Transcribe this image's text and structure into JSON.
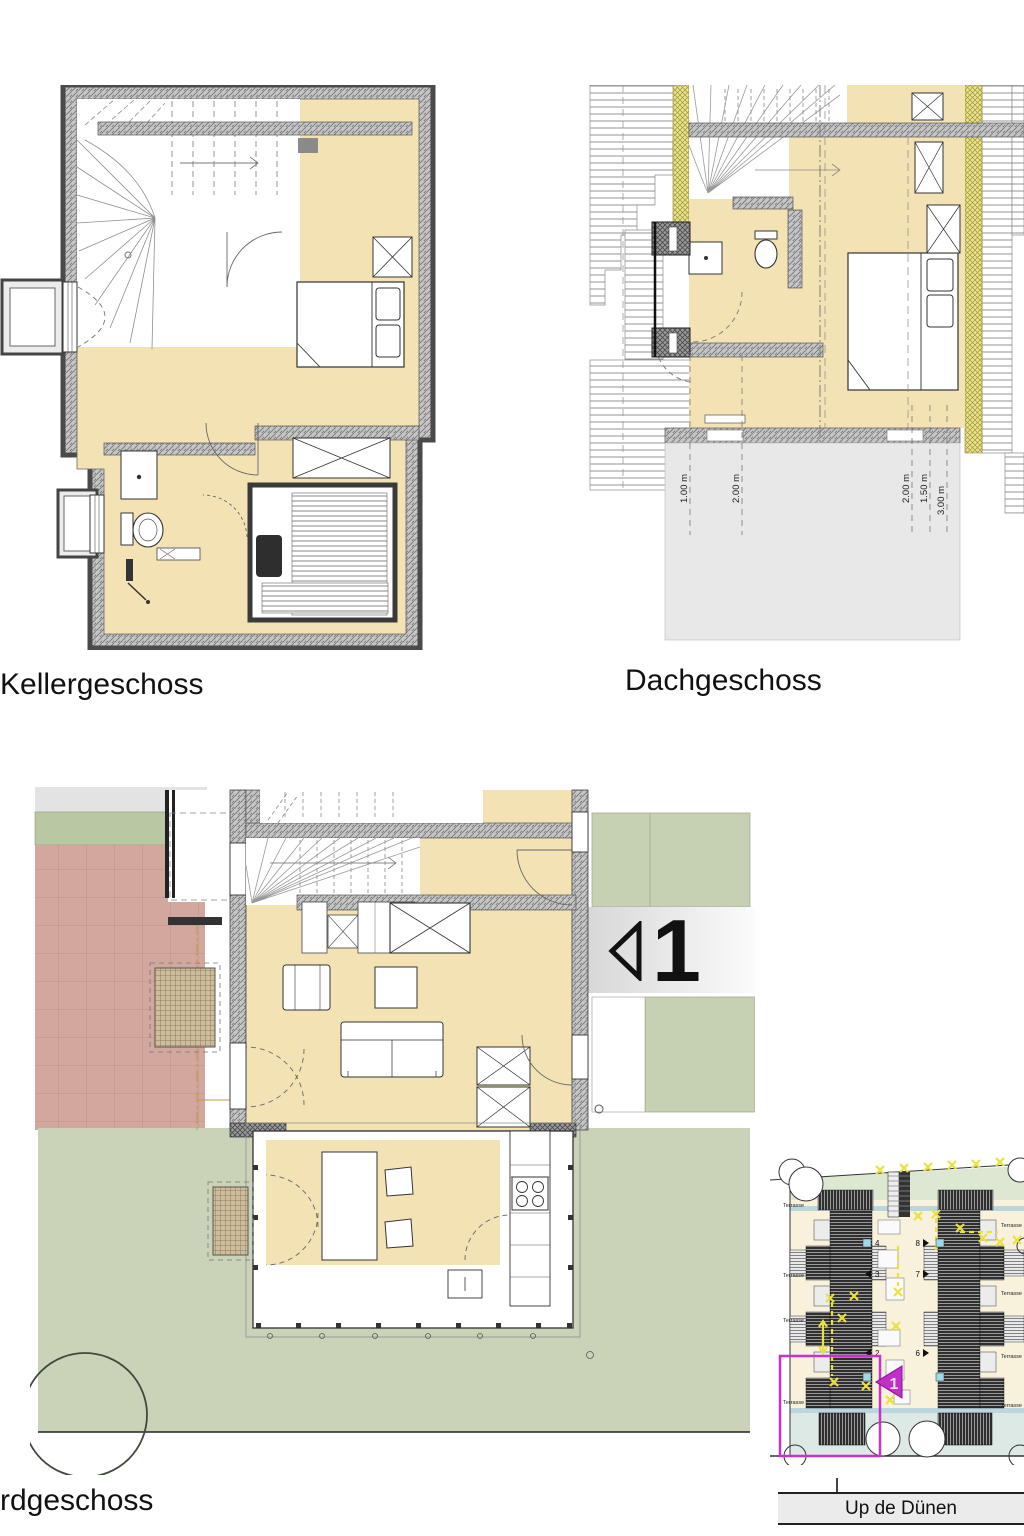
{
  "floorplans": {
    "keller": {
      "title": "Kellergeschoss"
    },
    "dach": {
      "title": "Dachgeschoss",
      "height_lines_left": [
        "1.00 m",
        "2.00 m"
      ],
      "height_lines_right": [
        "2.00 m",
        "1.50 m",
        "3.00 m"
      ]
    },
    "erd": {
      "title": "rdgeschoss",
      "unit_marker": "1"
    }
  },
  "site_plan": {
    "street_label": "Up de Dünen",
    "terrace_label": "Terrasse",
    "unit_numbers_left": [
      "4",
      "3",
      "2"
    ],
    "unit_numbers_right": [
      "8",
      "7",
      "6"
    ],
    "highlighted_unit": "1",
    "highlight_color": "#c832c8"
  },
  "palette": {
    "floor_beige": "#f3e3b4",
    "wall_gray": "#c6c6c6",
    "garden_green": "#cad3b8",
    "paving_red": "#d2a79d",
    "insulation_yellow": "#eae48f",
    "site_cream": "#f8f1dc",
    "water_blue": "#bcd6de"
  }
}
